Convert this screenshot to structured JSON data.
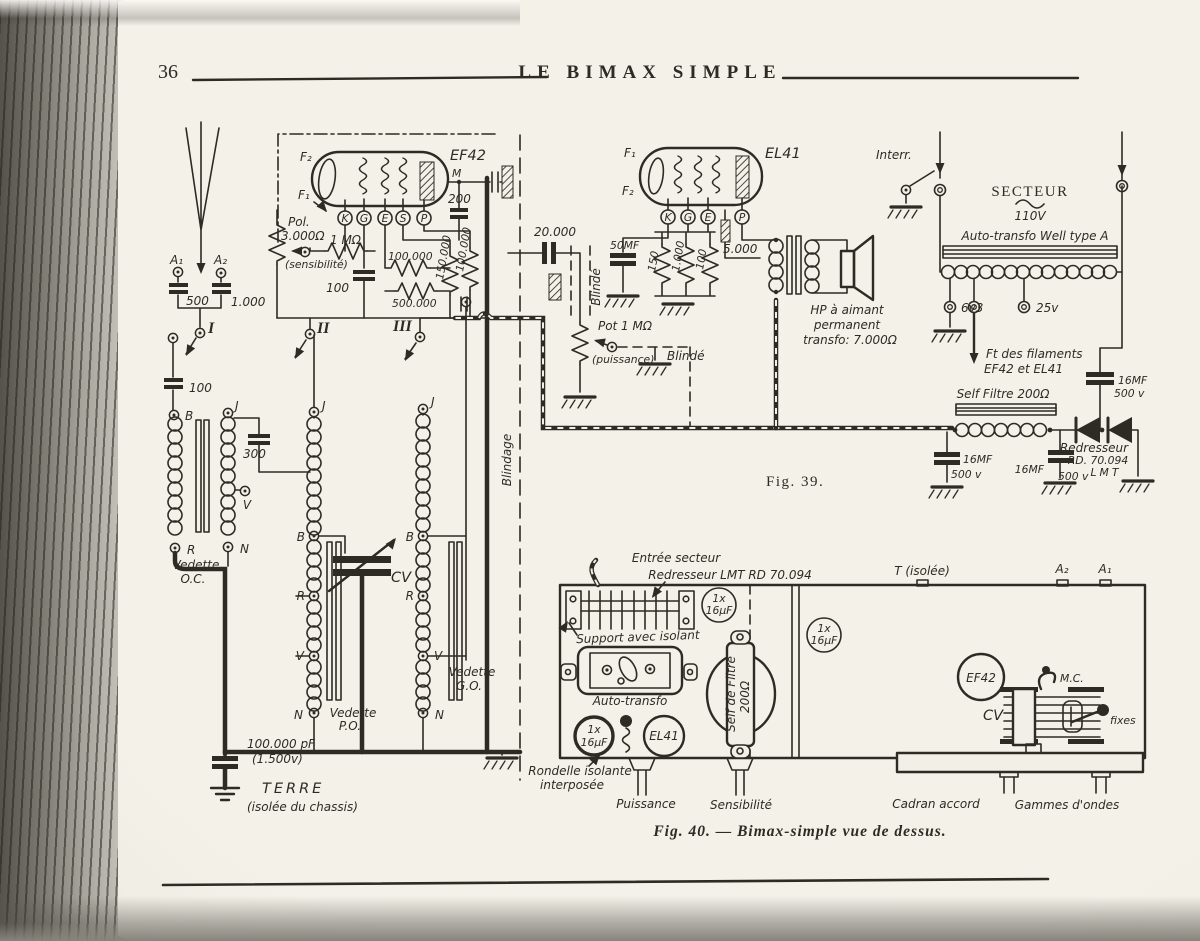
{
  "page": {
    "number": "36",
    "title": "LE BIMAX SIMPLE"
  },
  "fig39": {
    "caption": "Fig. 39.",
    "labels": {
      "a1": "A₁",
      "a2": "A₂",
      "c500": "500",
      "c1000": "1.000",
      "swI": "I",
      "swII": "II",
      "swIII": "III",
      "c100ant": "100",
      "B": "B",
      "J": "J",
      "R": "R",
      "V": "V",
      "N": "N",
      "c300": "300",
      "vedette": "Vedette",
      "oc": "O.C.",
      "po": "P.O.",
      "go": "G.O.",
      "cv": "CV",
      "c100kpf": "100.000 pF",
      "v1500": "(1.500v)",
      "terre": "TERRE",
      "terreSub": "(isolée du chassis)",
      "blindage": "Blindage",
      "ef42": "EF42",
      "f1": "F₁",
      "f2": "F₂",
      "m": "M",
      "K": "K",
      "G": "G",
      "E": "E",
      "S": "S",
      "P": "P",
      "c200": "200",
      "pol": "Pol.",
      "r3000": "3.000Ω",
      "r1meg": "1 MΩ",
      "sens": "(sensibilité)",
      "c100g": "100",
      "r100k": "100.000",
      "r150k": "150.000",
      "r100kb": "100.000",
      "r500k": "500.000",
      "c20000": "20.000",
      "blinde": "Blindé",
      "c50": "50MF",
      "r150": "150",
      "r1000": "1.000",
      "r100": "100",
      "r5000": "5.000",
      "pot": "Pot 1 MΩ",
      "puiss": "(puissance)",
      "blinde2": "Blindé",
      "el41": "EL41",
      "hp1": "HP à aimant",
      "hp2": "permanent",
      "hp3": "transfo: 7.000Ω",
      "interr": "Interr.",
      "secteur": "SECTEUR",
      "v110": "110V",
      "autotransfo": "Auto-transfo Well type A",
      "v63": "6v3",
      "v25": "25v",
      "fila1": "Ft des filaments",
      "fila2": "EF42 et EL41",
      "self": "Self Filtre 200Ω",
      "c16": "16MF",
      "v500": "500 v",
      "redresseur": "Redresseur",
      "rd": "RD. 70.094",
      "lmt": "LMT"
    }
  },
  "fig40": {
    "caption": "Fig. 40. — Bimax-simple vue de dessus.",
    "labels": {
      "entree": "Entrée secteur",
      "redresseur": "Redresseur LMT RD 70.094",
      "support": "Support avec isolant",
      "autotransfo": "Auto-transfo",
      "cap1x": "1x",
      "cap16": "16μF",
      "el41": "EL41",
      "selfa": "Self de Filtre",
      "selfb": "200Ω",
      "tisolee": "T (isolée)",
      "a2": "A₂",
      "a1": "A₁",
      "ef42": "EF42",
      "cv": "CV",
      "mc": "M.C.",
      "fixes": "fixes",
      "rondelle1": "Rondelle isolante",
      "rondelle2": "interposée",
      "puissance": "Puissance",
      "sensibilite": "Sensibilité",
      "cadran": "Cadran accord",
      "gammes": "Gammes d'ondes"
    }
  }
}
